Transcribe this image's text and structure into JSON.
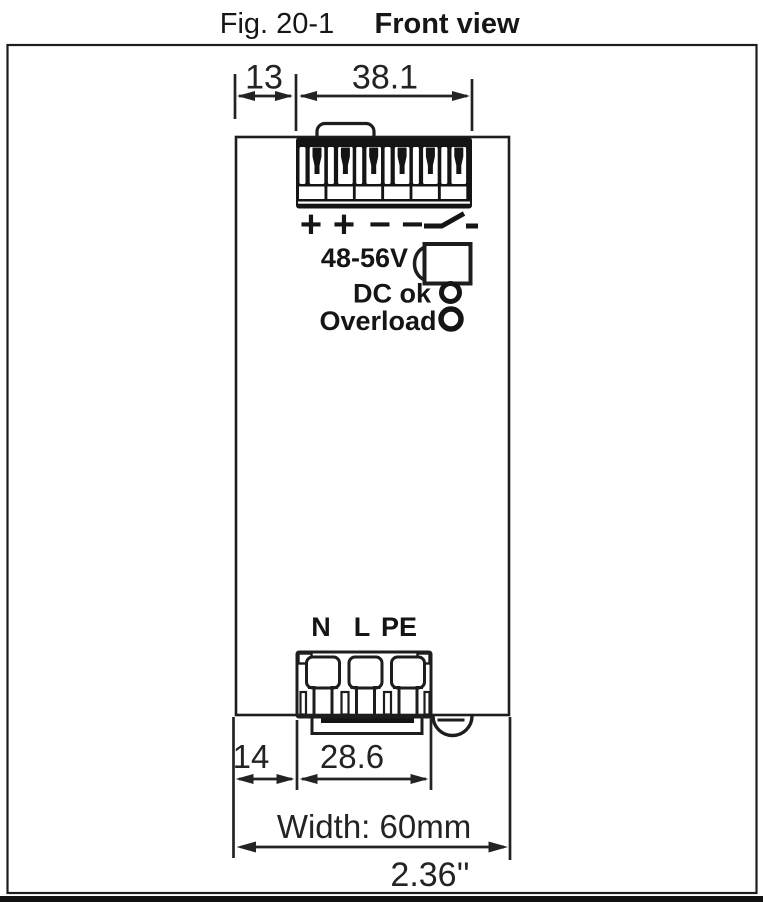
{
  "colors": {
    "ink": "#1a1a1a",
    "background": "#ffffff"
  },
  "figure": {
    "label": "Fig. 20-1",
    "title": "Front view"
  },
  "output_section": {
    "terminal_polarity": [
      "+",
      "+",
      "−",
      "−"
    ],
    "relay_symbol": "relay-contact",
    "voltage_range": "48-56V"
  },
  "indicators": {
    "dc_ok": "DC ok",
    "overload": "Overload"
  },
  "input_section": {
    "terminals": [
      "N",
      "L",
      "PE"
    ]
  },
  "dimensions": {
    "top_offset": "13",
    "output_connector_width": "38.1",
    "bottom_offset": "14",
    "input_connector_width": "28.6",
    "overall_width_metric": "Width: 60mm",
    "overall_width_imperial": "2.36''"
  }
}
